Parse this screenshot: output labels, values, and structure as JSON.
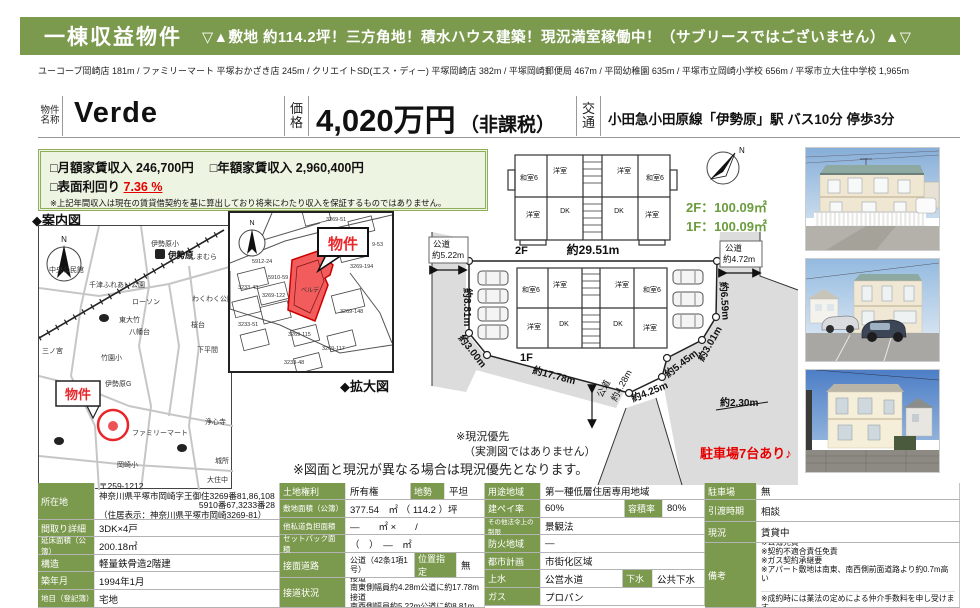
{
  "banner": {
    "title": "一棟収益物件",
    "subtitle": "▽▲敷地 約114.2坪！三方角地！積水ハウス建築！現況満室稼働中！（サブリースではございません）▲▽"
  },
  "facilities": "ユーコープ岡崎店 181m / ファミリーマート 平塚おかざき店 245m / クリエイトSD(エス・ディー) 平塚岡崎店 382m / 平塚岡崎郵便局 467m / 平岡幼稚園 635m / 平塚市立岡崎小学校 656m / 平塚市立大住中学校 1,965m",
  "property": {
    "name_label_1": "物件",
    "name_label_2": "名称",
    "name": "Verde",
    "price_label_1": "価",
    "price_label_2": "格",
    "price": "4,020万円",
    "price_note": "（非課税）",
    "access_label_1": "交",
    "access_label_2": "通",
    "access": "小田急小田原線「伊勢原」駅 バス10分 停歩3分"
  },
  "income": {
    "monthly_label": "□月額家賃収入",
    "monthly_value": "246,700円",
    "yearly_label": "□年額家賃収入",
    "yearly_value": "2,960,400円",
    "yield_label": "□表面利回り",
    "yield_value": "7.36 %",
    "note": "※上記年間収入は現在の賃貸借契約を基に算出しており将来にわたり収入を保証するものではありません。"
  },
  "guide_map": {
    "title": "◆案内図",
    "bukken": "物件",
    "compass": "N",
    "labels": {
      "station": "伊勢原",
      "elementary": "伊勢原小",
      "shimamura": "しまむら",
      "kominkan": "中央公民館",
      "park": "千津ふれあい公園",
      "lawson": "ローソン",
      "wakuwaku": "わくわく公園",
      "higashiotake": "東大竹",
      "sakuradai": "桜台",
      "hachimandai": "八幡台",
      "takezono": "竹園小",
      "shimohirama": "下平間",
      "sannomiya": "三ノ宮",
      "fujimino": "ふじみ野",
      "iseharag": "伊勢原G",
      "familymart": "ファミリーマート",
      "okazakisho": "岡崎小",
      "joshinji": "浄心寺",
      "kidokoro": "城所",
      "daijuchu": "大住中"
    }
  },
  "enlarged_map": {
    "title": "◆拡大図",
    "bukken": "物件",
    "property_parcel": "ベルデ",
    "parcels": [
      "5912-24",
      "5910-59",
      "3233-43",
      "3269-122",
      "3269-148",
      "3269-51",
      "3269-194",
      "9-53",
      "3233-51",
      "3269-115",
      "3269-117",
      "3233-48"
    ]
  },
  "floorplan": {
    "floor2": "2F",
    "floor1": "1F",
    "area2": "2F：100.09㎡",
    "area1": "1F：100.09㎡",
    "rooms": [
      "和室6",
      "洋室",
      "洋室",
      "和室6",
      "洋室",
      "DK",
      "DK",
      "洋室"
    ]
  },
  "siteplan": {
    "top": "約29.51m",
    "road_left_1": "公道",
    "road_left_2": "約5.22m",
    "left_881": "約8.81m",
    "d300": "約3.00m",
    "d1778": "約17.78m",
    "road_bottom_1": "公道",
    "road_bottom_2": "約4.28m",
    "d425": "約4.25m",
    "d545": "約5.45m",
    "d301": "約3.01m",
    "d659": "約6.59m",
    "road_right_1": "公道",
    "road_right_2": "約4.72m",
    "d230": "約2.30m",
    "parking": "駐車場7台あり♪"
  },
  "notes": {
    "priority1": "※現況優先",
    "priority2": "（実測図ではありません）",
    "drawing": "※図面と現況が異なる場合は現況優先となります。"
  },
  "table": {
    "a": [
      {
        "label": "所在地",
        "lines": [
          "〒259-1212",
          "神奈川県平塚市岡崎字王御住3269番81,86,108",
          "5910番67,3233番28",
          "（住居表示：神奈川県平塚市岡崎3269-81）"
        ]
      },
      {
        "label": "間取り詳細",
        "value": "3DK×4戸"
      },
      {
        "label": "延床面積（公簿）",
        "value": "200.18㎡"
      },
      {
        "label": "構造",
        "value": "軽量鉄骨造2階建"
      },
      {
        "label": "築年月",
        "value": "1994年1月"
      },
      {
        "label": "地目（登記簿）",
        "value": "宅地"
      }
    ],
    "b": [
      {
        "label": "土地権利",
        "value": "所有権",
        "sub_label": "地勢",
        "sub_value": "平坦"
      },
      {
        "label": "敷地面積（公簿）",
        "value": "377.54　㎡ （ 114.2 ）坪"
      },
      {
        "label": "他私道負担面積",
        "value": "―　　㎡ ×　　/"
      },
      {
        "label": "セットバック面積",
        "value": "（　）　―　㎡"
      },
      {
        "label": "接面道路",
        "value": "公道（42条1項1号）",
        "sub_label": "位置指定",
        "sub_value": "無"
      },
      {
        "label": "接道状況",
        "lines": [
          "北東側幅員約4.72m公道に約6.59m接道",
          "南東側幅員約4.28m公道に約17.78m接道",
          "南西側幅員約5.22m公道に約8.81m接道"
        ]
      }
    ],
    "c": [
      {
        "label": "用途地域",
        "value": "第一種低層住居専用地域"
      },
      {
        "label": "建ペイ率",
        "value": "60%",
        "sub_label": "容積率",
        "sub_value": "80%"
      },
      {
        "label": "その他法令上の制限",
        "value": "景観法"
      },
      {
        "label": "防火地域",
        "value": "―"
      },
      {
        "label": "都市計画",
        "value": "市街化区域"
      },
      {
        "label": "上水",
        "value": "公営水道",
        "sub_label": "下水",
        "sub_value": "公共下水"
      },
      {
        "label": "ガス",
        "value": "プロパン"
      }
    ],
    "d": [
      {
        "label": "駐車場",
        "value": "無"
      },
      {
        "label": "引渡時期",
        "value": "相談"
      },
      {
        "label": "現況",
        "value": "賃貸中"
      },
      {
        "label": "備考",
        "lines": [
          "※公簿売買",
          "※契約不適合責任免責",
          "※ガス契約承継要",
          "※アパート敷地は南東、南西側前面道路より約0.7m高い"
        ]
      }
    ],
    "agent_note": "※成約時には業法の定めによる仲介手数料を申し受けます。"
  }
}
